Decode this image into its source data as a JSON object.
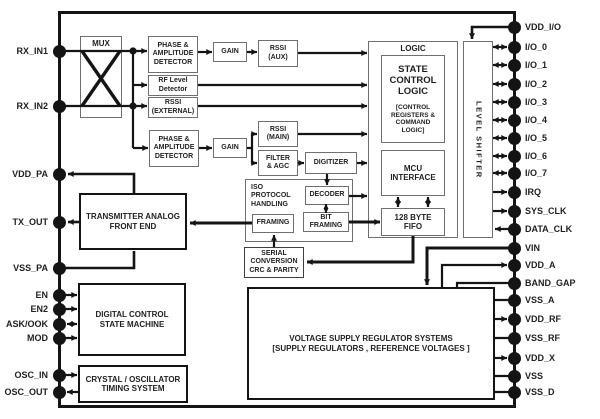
{
  "pins": {
    "left": [
      "RX_IN1",
      "RX_IN2",
      "VDD_PA",
      "TX_OUT",
      "VSS_PA",
      "EN",
      "EN2",
      "ASK/OOK",
      "MOD",
      "OSC_IN",
      "OSC_OUT"
    ],
    "right": [
      "VDD_I/O",
      "I/O_0",
      "I/O_1",
      "I/O_2",
      "I/O_3",
      "I/O_4",
      "I/O_5",
      "I/O_6",
      "I/O_7",
      "IRQ",
      "SYS_CLK",
      "DATA_CLK",
      "VIN",
      "VDD_A",
      "BAND_GAP",
      "VSS_A",
      "VDD_RF",
      "VSS_RF",
      "VDD_X",
      "VSS",
      "VSS_D"
    ]
  },
  "blocks": {
    "mux": {
      "lines": [
        "MUX"
      ]
    },
    "phase_amp_top": {
      "lines": [
        "PHASE &",
        "AMPLITUDE",
        "DETECTOR"
      ]
    },
    "gain_top": {
      "lines": [
        "GAIN"
      ]
    },
    "rssi_aux": {
      "lines": [
        "RSSI",
        "(AUX)"
      ]
    },
    "rf_level": {
      "lines": [
        "RF Level",
        "Detector"
      ]
    },
    "rssi_external": {
      "lines": [
        "RSSI",
        "(EXTERNAL)"
      ]
    },
    "phase_amp_main": {
      "lines": [
        "PHASE &",
        "AMPLITUDE",
        "DETECTOR"
      ]
    },
    "gain_main": {
      "lines": [
        "GAIN"
      ]
    },
    "rssi_main": {
      "lines": [
        "RSSI",
        "(MAIN)"
      ]
    },
    "filter_agc": {
      "lines": [
        "FILTER",
        "& AGC"
      ]
    },
    "digitizer": {
      "lines": [
        "DIGITIZER"
      ]
    },
    "iso_protocol": {
      "lines": [
        "ISO",
        "PROTOCOL",
        "HANDLING"
      ]
    },
    "decoder": {
      "lines": [
        "DECODER"
      ]
    },
    "framing": {
      "lines": [
        "FRAMING"
      ]
    },
    "bit_framing": {
      "lines": [
        "BIT",
        "FRAMING"
      ]
    },
    "serial_conversion": {
      "lines": [
        "SERIAL",
        "CONVERSION",
        "CRC & PARITY"
      ]
    },
    "logic": {
      "lines": [
        "LOGIC"
      ]
    },
    "state_control": {
      "lines": [
        "STATE",
        "CONTROL",
        "LOGIC"
      ],
      "sublines": [
        "[CONTROL",
        "REGISTERS &",
        "COMMAND",
        "LOGIC]"
      ]
    },
    "mcu_interface": {
      "lines": [
        "MCU",
        "INTERFACE"
      ]
    },
    "fifo": {
      "lines": [
        "128 BYTE",
        "FIFO"
      ]
    },
    "level_shifter": {
      "lines": [
        "LEVEL SHIFTER"
      ]
    },
    "transmitter": {
      "lines": [
        "TRANSMITTER ANALOG",
        "FRONT END"
      ]
    },
    "dcsm": {
      "lines": [
        "DIGITAL CONTROL",
        "STATE MACHINE"
      ]
    },
    "crystal": {
      "lines": [
        "CRYSTAL / OSCILLATOR",
        "TIMING SYSTEM"
      ]
    },
    "voltage": {
      "lines": [
        "VOLTAGE SUPPLY REGULATOR SYSTEMS",
        "[SUPPLY REGULATORS , REFERENCE VOLTAGES ]"
      ]
    }
  },
  "colors": {
    "wire": "#141414",
    "gray_border": "#6f6f6f",
    "black_border": "#141414",
    "text": "#1f1f1f",
    "background": "#ffffff",
    "pin": "#141414"
  }
}
